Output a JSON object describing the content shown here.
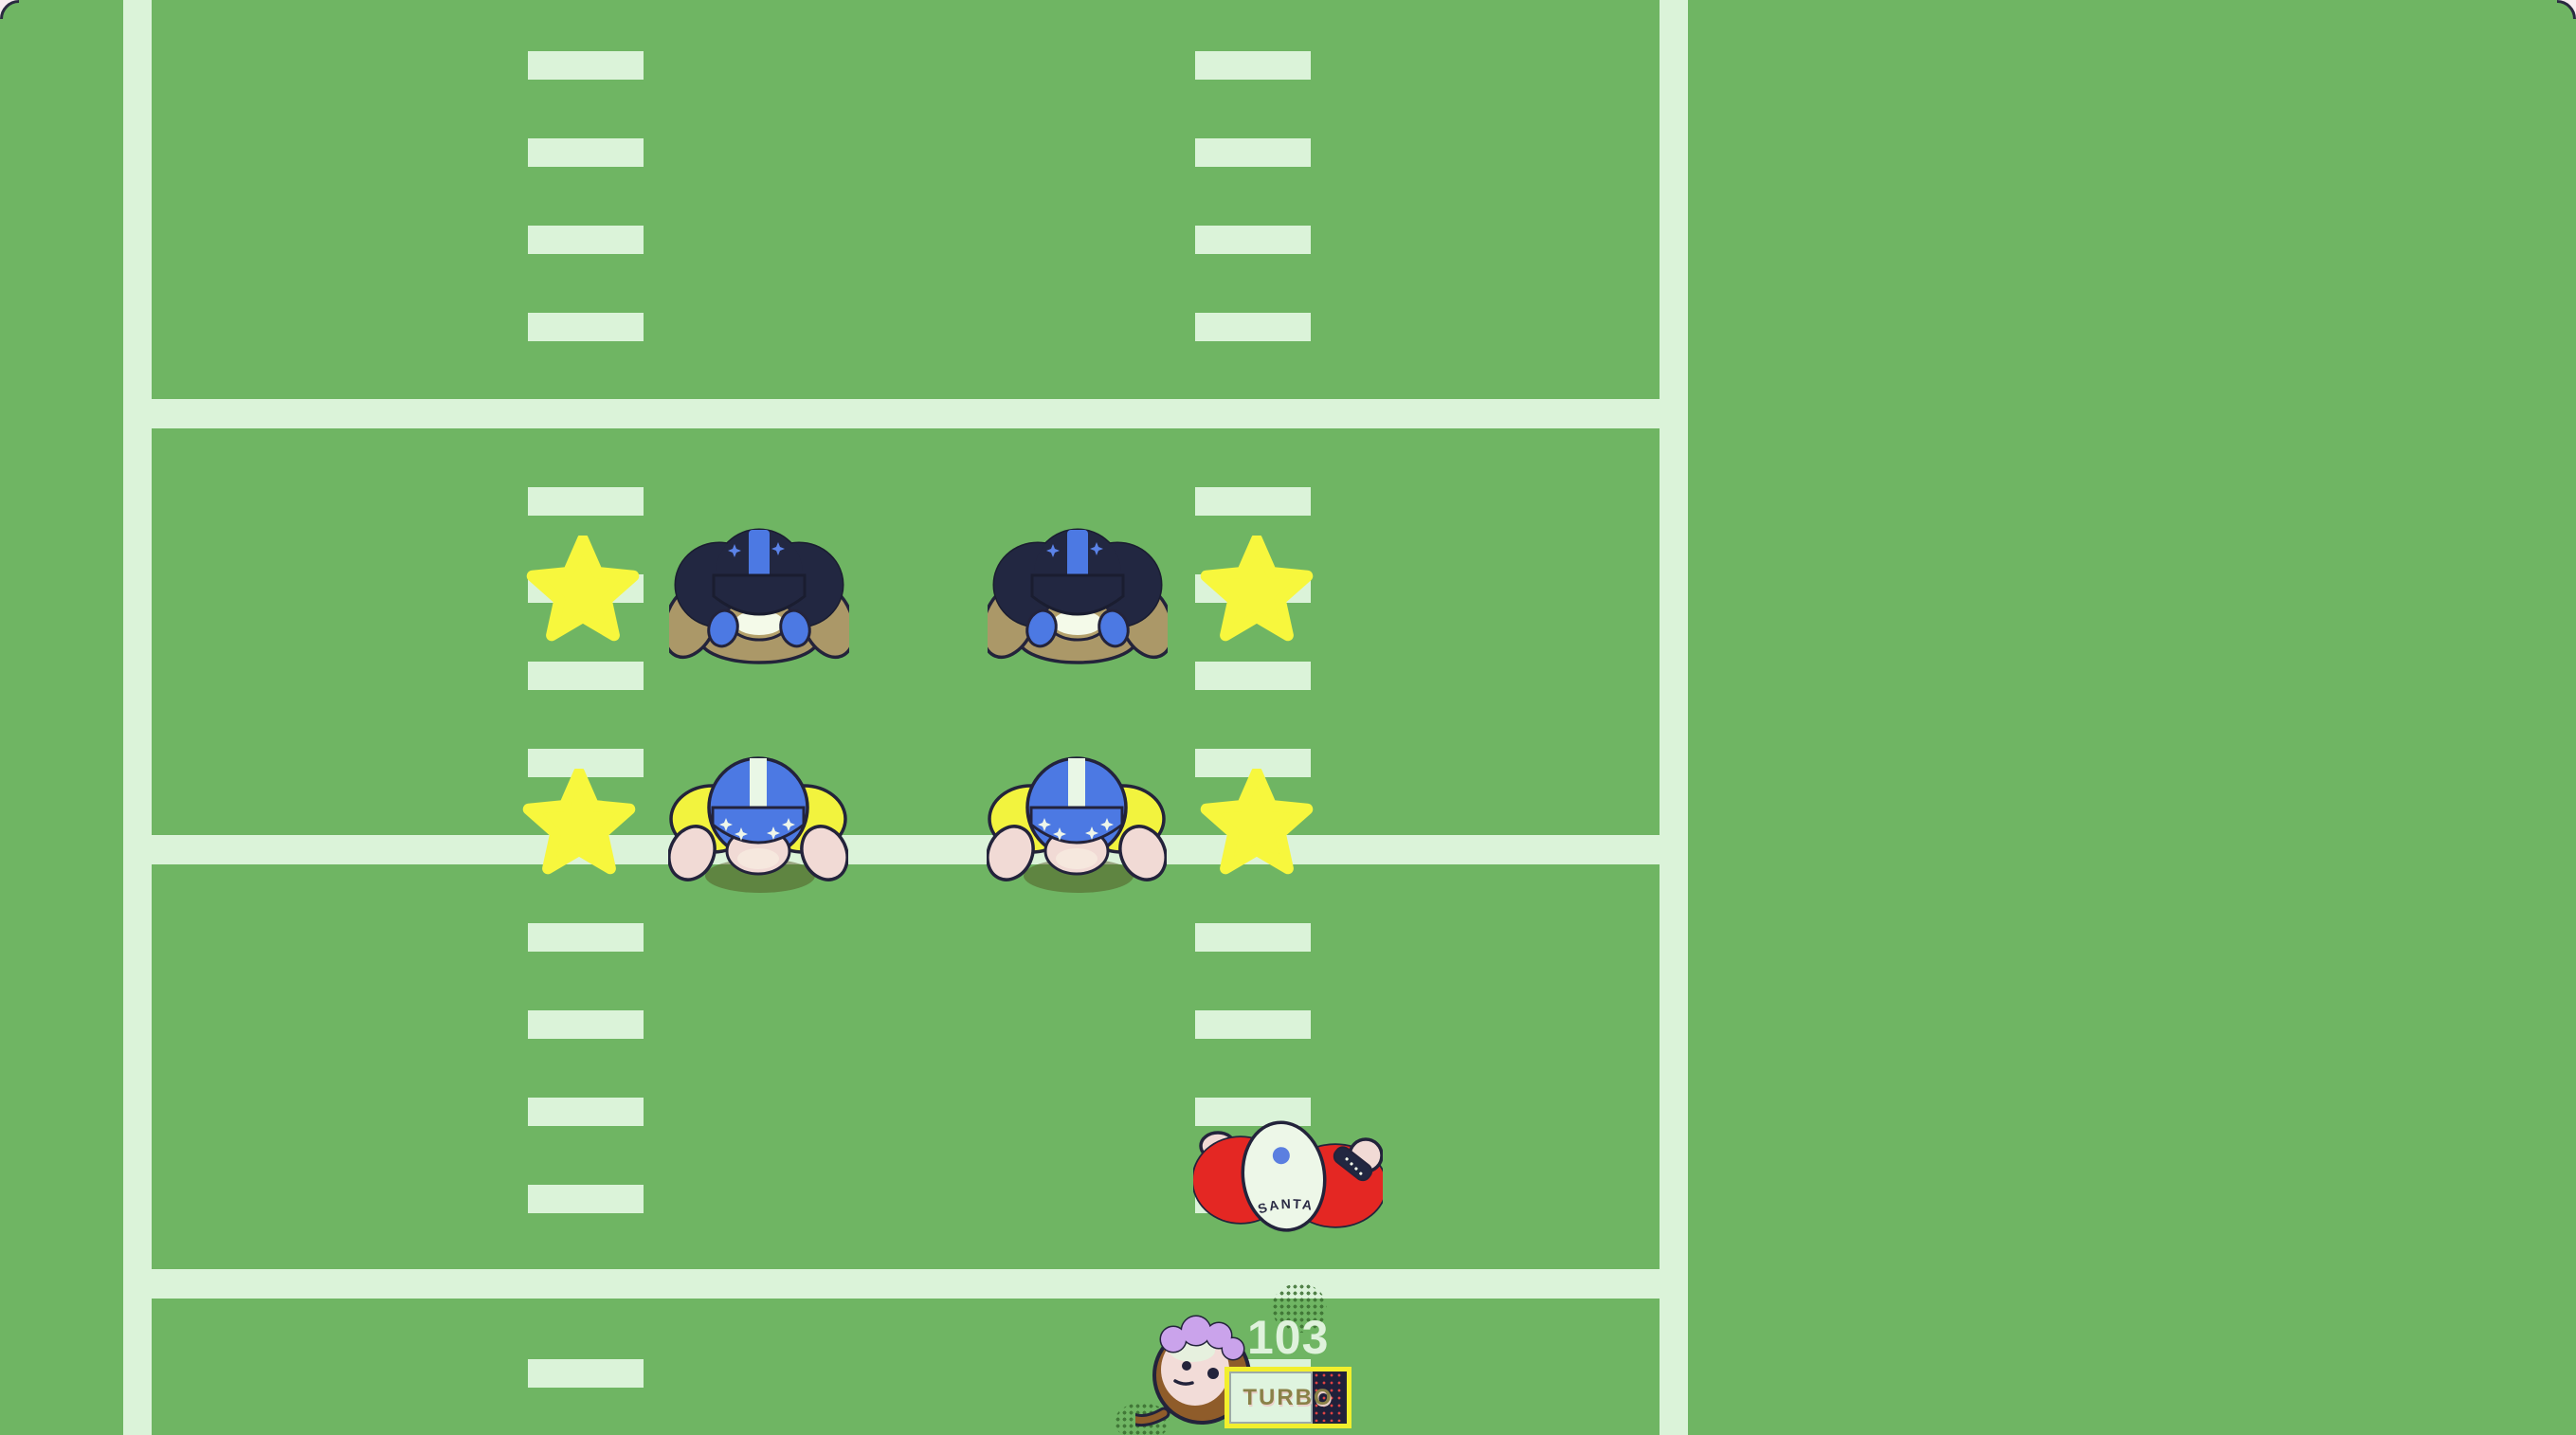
{
  "game": {
    "hud": {
      "score": "103",
      "turbo_label": "TURBO",
      "turbo_fill_percent": 71
    },
    "characters": {
      "santa_jersey_text": "SANTA",
      "dark_opponents_count": 2,
      "blue_teammates_count": 2,
      "stars_count": 4
    },
    "colors": {
      "field_green": "#6fb563",
      "field_line_light": "#dbf3d9",
      "star_yellow": "#f7f73d",
      "dark_jersey_navy": "#222741",
      "helmet_blue": "#4c79e3",
      "shoulder_yellow": "#f2f33e",
      "skin_pink": "#f1dad5",
      "arm_tan": "#ab9868",
      "santa_red": "#e42723",
      "turbo_border_yellow": "#f2ef2d",
      "turbo_empty_navy": "#20203a",
      "turbo_dot_red": "#e04343",
      "score_text_light": "#dff2dc",
      "page_background_pink": "#f9edf1"
    }
  }
}
